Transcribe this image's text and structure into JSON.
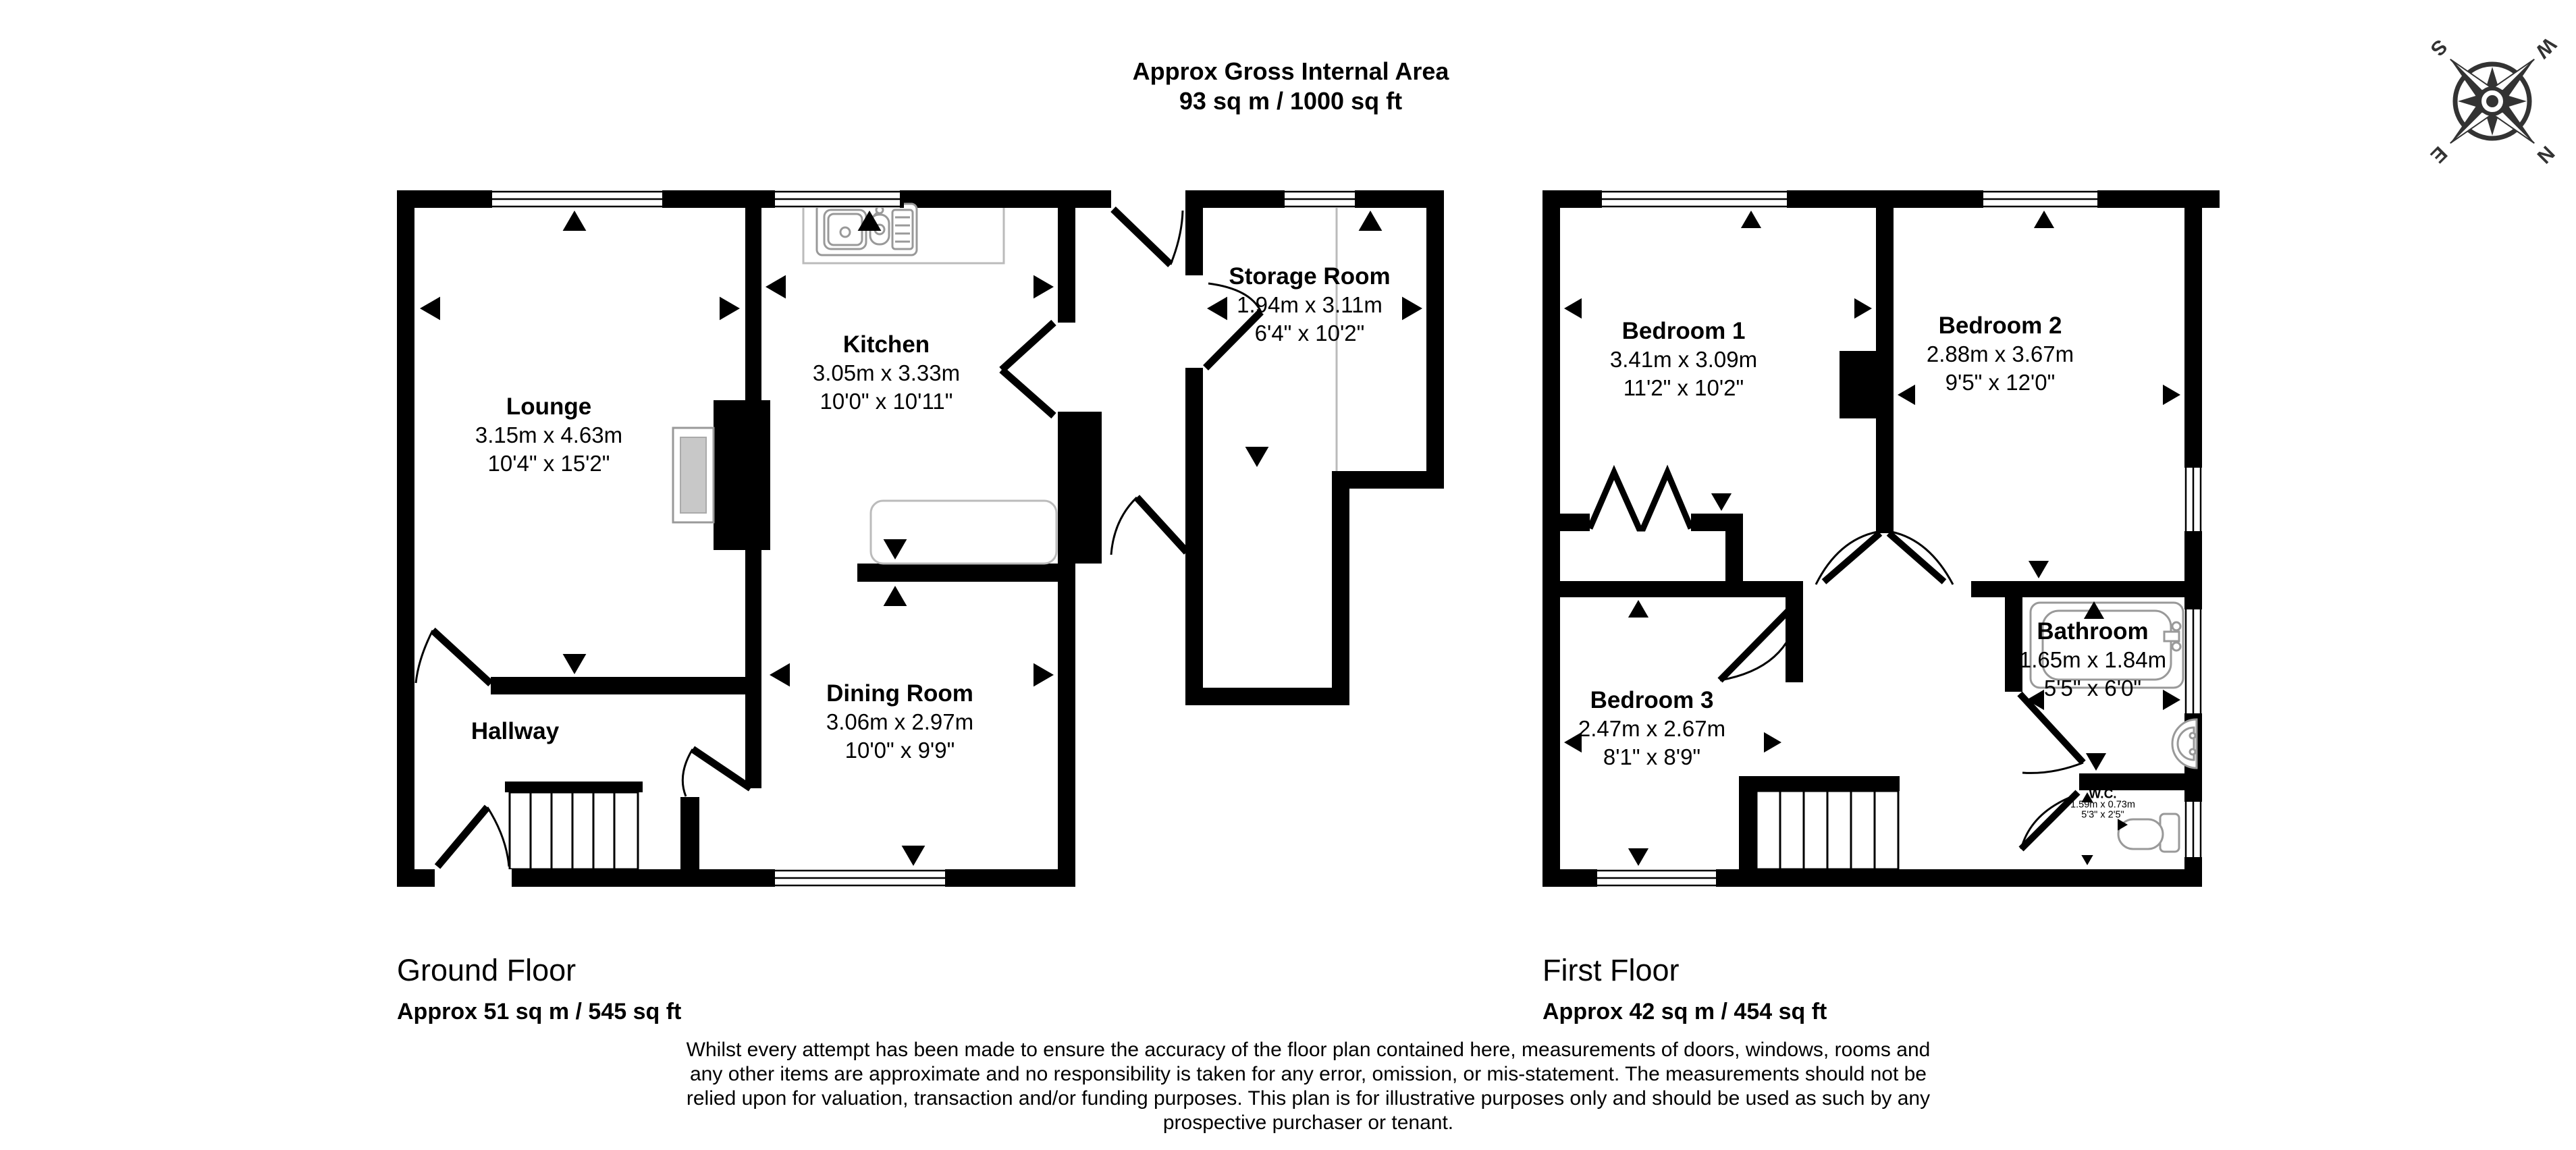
{
  "header": {
    "title": "Approx Gross Internal Area",
    "subtitle": "93 sq m / 1000 sq ft"
  },
  "compass": {
    "north": "N",
    "south": "S",
    "east": "E",
    "west": "W"
  },
  "floors": {
    "ground": {
      "title": "Ground Floor",
      "area": "Approx 51 sq m / 545 sq ft",
      "rooms": {
        "lounge": {
          "name": "Lounge",
          "metric": "3.15m x 4.63m",
          "imperial": "10'4\" x 15'2\""
        },
        "kitchen": {
          "name": "Kitchen",
          "metric": "3.05m x 3.33m",
          "imperial": "10'0\" x 10'11\""
        },
        "storage": {
          "name": "Storage Room",
          "metric": "1.94m x 3.11m",
          "imperial": "6'4\" x 10'2\""
        },
        "dining": {
          "name": "Dining Room",
          "metric": "3.06m x 2.97m",
          "imperial": "10'0\" x 9'9\""
        },
        "hallway": {
          "name": "Hallway"
        }
      }
    },
    "first": {
      "title": "First Floor",
      "area": "Approx 42 sq m / 454 sq ft",
      "rooms": {
        "bedroom1": {
          "name": "Bedroom 1",
          "metric": "3.41m x 3.09m",
          "imperial": "11'2\" x 10'2\""
        },
        "bedroom2": {
          "name": "Bedroom 2",
          "metric": "2.88m x 3.67m",
          "imperial": "9'5\" x 12'0\""
        },
        "bedroom3": {
          "name": "Bedroom 3",
          "metric": "2.47m x 2.67m",
          "imperial": "8'1\" x 8'9\""
        },
        "bathroom": {
          "name": "Bathroom",
          "metric": "1.65m x 1.84m",
          "imperial": "5'5\" x 6'0\""
        },
        "wc": {
          "name": "W.C.",
          "metric": "1.59m x 0.73m",
          "imperial": "5'3\" x 2'5\""
        }
      }
    }
  },
  "disclaimer": {
    "lines": [
      "Whilst every attempt has been made to ensure the accuracy of the floor plan contained here, measurements of doors, windows, rooms and",
      "any other items are approximate and no responsibility is taken for any error, omission, or mis-statement. The measurements should not be",
      "relied upon for valuation, transaction and/or funding purposes. This plan is for illustrative purposes only and should be used as such by any",
      "prospective purchaser or tenant."
    ]
  }
}
